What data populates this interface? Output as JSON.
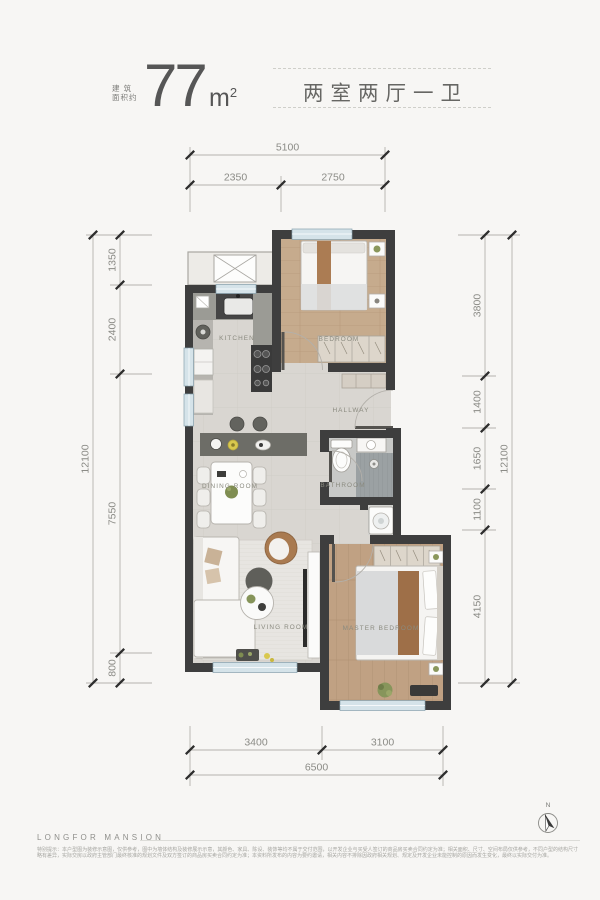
{
  "header": {
    "area_label_line1": "建 筑",
    "area_label_line2": "面积约",
    "area_value": "77",
    "area_unit": "m",
    "area_exponent": "2",
    "title": "两室两厅一卫"
  },
  "dims": {
    "top": {
      "total": "5100",
      "segments": [
        "2350",
        "2750"
      ]
    },
    "bottom": {
      "total": "6500",
      "segments": [
        "3400",
        "3100"
      ]
    },
    "left": {
      "total": "12100",
      "segments": [
        "1350",
        "2400",
        "7550",
        "800"
      ]
    },
    "right": {
      "total": "12100",
      "segments": [
        "3800",
        "1400",
        "1650",
        "1100",
        "4150"
      ]
    }
  },
  "rooms": {
    "kitchen": "KITCHEN",
    "bedroom": "BEDROOM",
    "hallway": "HALLWAY",
    "dining": "DINING ROOM",
    "bathroom": "BATHROOM",
    "living": "LIVING ROOM",
    "master": "MASTER BEDROOM"
  },
  "footer": {
    "brand": "LONGFOR MANSION",
    "compass": "N",
    "disclaimer": "特别提示：本户型图为装修示意图，仅供参考，图中为墙体结构及装修展示示意，其颜色、家具、陈设、装饰等均不属于交付范围，以开发企业与买受人签订的商品房买卖合同约定为准；相关面积、尺寸、空间布局仅供参考，不同户型的结构尺寸略有差异，实际交房以政府主管部门最终核准的规划文件及双方签订的商品房买卖合同约定为准；本资料所发布的内容为要约邀请，相关内容不排除因政府相关规划、规定及开发企业未能控制的原因而发生变化，最终以实际交付为准。"
  },
  "colors": {
    "wall": "#3e3e3e",
    "tile": "#d9d6d1",
    "wood": "#c2a486",
    "glass": "#d5e3e9",
    "dim_text": "#8b8b86"
  }
}
